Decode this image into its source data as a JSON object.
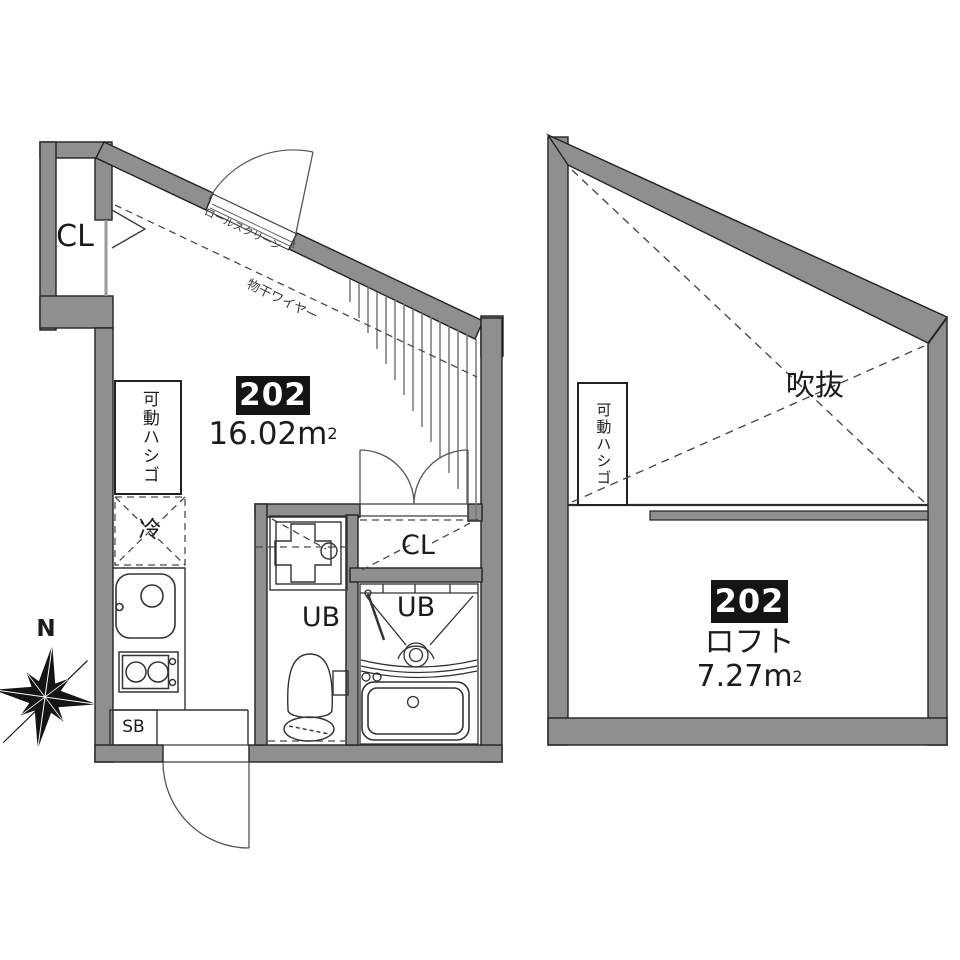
{
  "plan_main": {
    "unit_number": "202",
    "area_value": "16.02",
    "area_unit": "m",
    "area_sup": "2",
    "labels": {
      "closet_upper": "CL",
      "closet_middle": "CL",
      "roll_screen": "ロールスクリーン",
      "laundry_wire": "物干ワイヤー",
      "movable_ladder": "可動ハシゴ",
      "refrigerator": "冷",
      "unit_bath_toilet": "UB",
      "unit_bath_bathroom": "UB",
      "shoe_box": "SB"
    }
  },
  "plan_loft": {
    "unit_number": "202",
    "room_label": "ロフト",
    "area_value": "7.27",
    "area_unit": "m",
    "area_sup": "2",
    "labels": {
      "open_void": "吹抜",
      "movable_ladder": "可動ハシゴ"
    }
  },
  "compass": {
    "north_label": "N"
  },
  "colors": {
    "background": "#ffffff",
    "wall_fill": "#8f8f8f",
    "wall_outline": "#222222",
    "line_color": "#3c3c3c",
    "badge_background": "#141414",
    "badge_text": "#ffffff"
  }
}
